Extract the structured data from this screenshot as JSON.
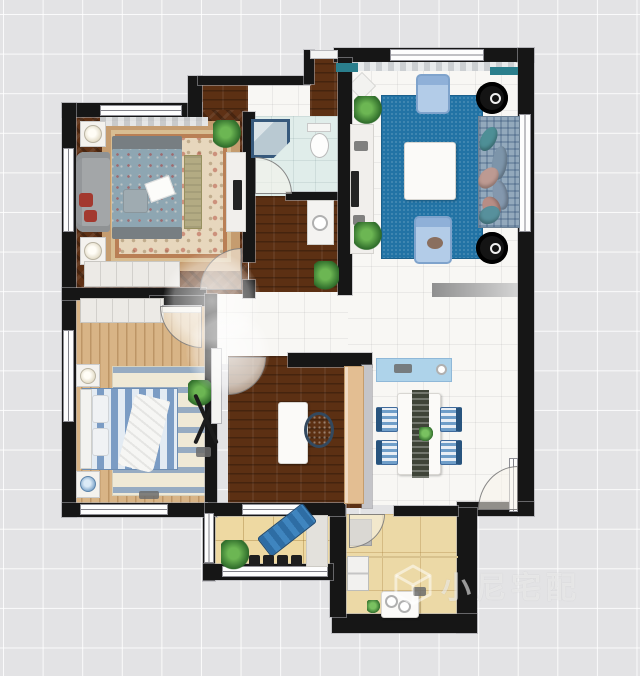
{
  "watermark": {
    "text": "小尼宅配"
  },
  "canvas": {
    "width": 640,
    "height": 676,
    "background": "#e3e3e5",
    "grid_line": "#ffffff"
  },
  "palette": {
    "wall": "#161616",
    "blue_carpet": "#2273a5",
    "dark_wood": "#5c3013",
    "light_wood": "#d8b486",
    "balcony_tile": "#eed9a2",
    "bath_floor": "#e0edea",
    "accent_teal": "#2a7e8c",
    "console_blue": "#aed3ea",
    "lounge_blue": "#2e6da4"
  },
  "elements": [
    {
      "n": "floor-living-dining",
      "k": "tile",
      "x": 345,
      "y": 58,
      "w": 175,
      "h": 447
    },
    {
      "n": "floor-center-hall",
      "k": "tile",
      "x": 200,
      "y": 286,
      "w": 148,
      "h": 78
    },
    {
      "n": "floor-entry",
      "k": "tile",
      "x": 246,
      "y": 78,
      "w": 68,
      "h": 42
    },
    {
      "n": "floor-entry-corridor",
      "k": "darkwood",
      "x": 310,
      "y": 54,
      "w": 30,
      "h": 66
    },
    {
      "n": "floor-entry-niche",
      "k": "darkwood",
      "x": 198,
      "y": 81,
      "w": 50,
      "h": 32
    },
    {
      "n": "floor-bedroom1",
      "k": "herringbone",
      "x": 70,
      "y": 110,
      "w": 178,
      "h": 184
    },
    {
      "n": "floor-bathroom",
      "k": "bath",
      "x": 249,
      "y": 116,
      "w": 92,
      "h": 82
    },
    {
      "n": "floor-hall-wood",
      "k": "darkwood",
      "x": 249,
      "y": 196,
      "w": 92,
      "h": 96
    },
    {
      "n": "floor-study",
      "k": "darkwood",
      "x": 228,
      "y": 356,
      "w": 142,
      "h": 152
    },
    {
      "n": "floor-bedroom2",
      "k": "lightwood",
      "x": 72,
      "y": 294,
      "w": 142,
      "h": 214
    },
    {
      "n": "floor-balcony",
      "k": "balconytile",
      "x": 213,
      "y": 510,
      "w": 120,
      "h": 62
    },
    {
      "n": "floor-kitchen",
      "k": "kitchentile",
      "x": 344,
      "y": 514,
      "w": 116,
      "h": 106
    },
    {
      "n": "rug-master",
      "k": "rugoriental",
      "x": 102,
      "y": 121,
      "w": 138,
      "h": 150
    },
    {
      "n": "carpet-living",
      "k": "bluecarpet",
      "x": 382,
      "y": 96,
      "w": 100,
      "h": 162
    },
    {
      "n": "rug-bedroom2",
      "k": "rugstripes",
      "x": 112,
      "y": 366,
      "w": 104,
      "h": 130
    },
    {
      "n": "mat-living-dining",
      "k": "graymat",
      "x": 432,
      "y": 283,
      "w": 88,
      "h": 14
    },
    {
      "n": "rug-diamond",
      "k": "diamond",
      "x": 352,
      "y": 76,
      "w": 20,
      "h": 20,
      "r": 45
    },
    {
      "n": "wall-top-bedroom",
      "k": "wall",
      "x": 62,
      "y": 103,
      "w": 140,
      "h": 14
    },
    {
      "n": "wall-step-left",
      "k": "wall",
      "x": 188,
      "y": 76,
      "w": 14,
      "h": 41
    },
    {
      "n": "wall-top-entry",
      "k": "wall",
      "x": 198,
      "y": 76,
      "w": 112,
      "h": 9
    },
    {
      "n": "wall-step-entry",
      "k": "wall",
      "x": 304,
      "y": 50,
      "w": 10,
      "h": 34
    },
    {
      "n": "wall-top-living",
      "k": "wall",
      "x": 334,
      "y": 48,
      "w": 200,
      "h": 14
    },
    {
      "n": "wall-right",
      "k": "wall",
      "x": 518,
      "y": 48,
      "w": 16,
      "h": 468
    },
    {
      "n": "wall-left",
      "k": "wall",
      "x": 62,
      "y": 103,
      "w": 14,
      "h": 414
    },
    {
      "n": "wall-bed1-bottom",
      "k": "wall",
      "x": 62,
      "y": 288,
      "w": 144,
      "h": 12
    },
    {
      "n": "wall-bed2-top-stub",
      "k": "wall",
      "x": 150,
      "y": 296,
      "w": 60,
      "h": 10
    },
    {
      "n": "wall-bed1-right",
      "k": "wall",
      "x": 243,
      "y": 112,
      "w": 12,
      "h": 150
    },
    {
      "n": "wall-bed1-right-stub",
      "k": "wall",
      "x": 243,
      "y": 280,
      "w": 12,
      "h": 18
    },
    {
      "n": "wall-bath-bottom",
      "k": "wall",
      "x": 286,
      "y": 192,
      "w": 55,
      "h": 8
    },
    {
      "n": "wall-living-left",
      "k": "wall",
      "x": 338,
      "y": 58,
      "w": 14,
      "h": 237
    },
    {
      "n": "wall-study-top",
      "k": "wall",
      "x": 288,
      "y": 353,
      "w": 84,
      "h": 14
    },
    {
      "n": "wall-study-right",
      "k": "graywall",
      "x": 362,
      "y": 365,
      "w": 10,
      "h": 143
    },
    {
      "n": "wall-bed2-right",
      "k": "wall",
      "x": 205,
      "y": 294,
      "w": 12,
      "h": 223
    },
    {
      "n": "wall-dining-bottom",
      "k": "wall",
      "x": 457,
      "y": 502,
      "w": 77,
      "h": 14
    },
    {
      "n": "wall-kitchen-right",
      "k": "wall",
      "x": 457,
      "y": 508,
      "w": 20,
      "h": 125
    },
    {
      "n": "wall-kitchen-bottom",
      "k": "wall",
      "x": 332,
      "y": 614,
      "w": 145,
      "h": 19
    },
    {
      "n": "wall-kitchen-left",
      "k": "wall",
      "x": 330,
      "y": 505,
      "w": 16,
      "h": 112
    },
    {
      "n": "wall-kitchen-top",
      "k": "wall",
      "x": 394,
      "y": 506,
      "w": 64,
      "h": 10
    },
    {
      "n": "wall-balcony-left",
      "k": "wall",
      "x": 203,
      "y": 505,
      "w": 12,
      "h": 76
    },
    {
      "n": "wall-balcony-bottom",
      "k": "wall",
      "x": 203,
      "y": 564,
      "w": 130,
      "h": 16
    },
    {
      "n": "wall-bed2-bottom",
      "k": "wall",
      "x": 62,
      "y": 503,
      "w": 145,
      "h": 14
    },
    {
      "n": "wall-study-bottom",
      "k": "wall",
      "x": 205,
      "y": 503,
      "w": 140,
      "h": 13
    },
    {
      "n": "window-bed1-top",
      "k": "windowh",
      "x": 100,
      "y": 105,
      "w": 82,
      "h": 11
    },
    {
      "n": "window-bed1-left",
      "k": "windowv",
      "x": 63,
      "y": 148,
      "w": 11,
      "h": 84
    },
    {
      "n": "window-bed2-left",
      "k": "windowv",
      "x": 63,
      "y": 330,
      "w": 11,
      "h": 92
    },
    {
      "n": "window-living-top",
      "k": "windowh",
      "x": 390,
      "y": 49,
      "w": 94,
      "h": 12
    },
    {
      "n": "window-living-right",
      "k": "windowv",
      "x": 519,
      "y": 114,
      "w": 12,
      "h": 118
    },
    {
      "n": "window-bed2-bottom",
      "k": "windowh",
      "x": 80,
      "y": 504,
      "w": 88,
      "h": 11
    },
    {
      "n": "window-study-bottom",
      "k": "windowh",
      "x": 242,
      "y": 504,
      "w": 60,
      "h": 11
    },
    {
      "n": "window-balcony-bottom",
      "k": "windowh",
      "x": 222,
      "y": 566,
      "w": 106,
      "h": 11
    },
    {
      "n": "window-balcony-left",
      "k": "windowv",
      "x": 204,
      "y": 513,
      "w": 10,
      "h": 50
    },
    {
      "n": "threshold-entry",
      "k": "thresh",
      "x": 310,
      "y": 50,
      "w": 28,
      "h": 9
    },
    {
      "n": "doorframe-dining-right",
      "k": "windowv",
      "x": 509,
      "y": 458,
      "w": 9,
      "h": 54
    },
    {
      "n": "curtain-living",
      "k": "curtain",
      "x": 352,
      "y": 62,
      "w": 164,
      "h": 9
    },
    {
      "n": "curtain-bed1",
      "k": "curtain",
      "x": 100,
      "y": 117,
      "w": 108,
      "h": 9
    },
    {
      "n": "entry-door-leaf",
      "k": "tealbar",
      "x": 336,
      "y": 63,
      "w": 22,
      "h": 9
    },
    {
      "n": "ac-unit-right",
      "k": "tealbar",
      "x": 490,
      "y": 67,
      "w": 28,
      "h": 8
    },
    {
      "n": "bed1-headboard",
      "k": "headboard",
      "x": 112,
      "y": 136,
      "w": 70,
      "h": 15
    },
    {
      "n": "bed1",
      "k": "bedmaster",
      "x": 112,
      "y": 149,
      "w": 70,
      "h": 80
    },
    {
      "n": "bed1-footboard",
      "k": "headboard",
      "x": 112,
      "y": 227,
      "w": 70,
      "h": 12
    },
    {
      "n": "bed1-pillow",
      "k": "pillowgray",
      "x": 123,
      "y": 189,
      "w": 25,
      "h": 24
    },
    {
      "n": "bed1-magazine",
      "k": "paper",
      "x": 147,
      "y": 179,
      "w": 26,
      "h": 20,
      "r": -20
    },
    {
      "n": "bench-bed1",
      "k": "bench",
      "x": 184,
      "y": 155,
      "w": 18,
      "h": 74
    },
    {
      "n": "sofa-bed1",
      "k": "graysofa",
      "x": 76,
      "y": 152,
      "w": 34,
      "h": 80
    },
    {
      "n": "sofa-cushion-red1",
      "k": "redpillow",
      "x": 79,
      "y": 193,
      "w": 14,
      "h": 14
    },
    {
      "n": "sofa-cushion-red2",
      "k": "redpillow",
      "x": 84,
      "y": 210,
      "w": 13,
      "h": 12
    },
    {
      "n": "nightstand-bed1-top",
      "k": "nightstand",
      "x": 80,
      "y": 121,
      "w": 26,
      "h": 26
    },
    {
      "n": "lamp-bed1-top",
      "k": "lamp",
      "x": 84,
      "y": 125,
      "w": 18,
      "h": 18
    },
    {
      "n": "nightstand-bed1-bottom",
      "k": "nightstand",
      "x": 80,
      "y": 237,
      "w": 26,
      "h": 28
    },
    {
      "n": "lamp-bed1-bottom",
      "k": "lamp",
      "x": 84,
      "y": 242,
      "w": 18,
      "h": 18
    },
    {
      "n": "wardrobe-bed1",
      "k": "wardrobe",
      "x": 84,
      "y": 261,
      "w": 96,
      "h": 26
    },
    {
      "n": "dresser-bed1",
      "k": "dresser",
      "x": 226,
      "y": 152,
      "w": 20,
      "h": 80
    },
    {
      "n": "tv-bed1",
      "k": "tv",
      "x": 233,
      "y": 180,
      "w": 9,
      "h": 30
    },
    {
      "n": "plant-bed1",
      "k": "plant",
      "x": 213,
      "y": 120,
      "w": 28,
      "h": 28
    },
    {
      "n": "door-bed1",
      "k": "arc-tl",
      "x": 200,
      "y": 248,
      "w": 42,
      "h": 42
    },
    {
      "n": "shower",
      "k": "shower",
      "x": 251,
      "y": 119,
      "w": 39,
      "h": 39
    },
    {
      "n": "toilet-tank",
      "k": "toilettank",
      "x": 307,
      "y": 123,
      "w": 24,
      "h": 9
    },
    {
      "n": "toilet-bowl",
      "k": "toiletbowl",
      "x": 310,
      "y": 133,
      "w": 19,
      "h": 25
    },
    {
      "n": "door-bathroom",
      "k": "arc-tr",
      "x": 255,
      "y": 157,
      "w": 37,
      "h": 37
    },
    {
      "n": "vanity-hall",
      "k": "vanity",
      "x": 307,
      "y": 200,
      "w": 27,
      "h": 45
    },
    {
      "n": "sink-vanity",
      "k": "burner",
      "x": 312,
      "y": 215,
      "w": 16,
      "h": 16
    },
    {
      "n": "plant-hall",
      "k": "plant",
      "x": 314,
      "y": 261,
      "w": 25,
      "h": 30
    },
    {
      "n": "tv-console-living",
      "k": "dresser",
      "x": 350,
      "y": 124,
      "w": 24,
      "h": 130
    },
    {
      "n": "tv-living",
      "k": "tv",
      "x": 351,
      "y": 171,
      "w": 8,
      "h": 36
    },
    {
      "n": "decor-glasses",
      "k": "smallitem",
      "x": 354,
      "y": 141,
      "w": 14,
      "h": 10
    },
    {
      "n": "decor-remotes",
      "k": "smallitem",
      "x": 353,
      "y": 215,
      "w": 12,
      "h": 10
    },
    {
      "n": "plant-living-top",
      "k": "plant",
      "x": 354,
      "y": 96,
      "w": 28,
      "h": 28
    },
    {
      "n": "plant-living-bottom",
      "k": "plant",
      "x": 354,
      "y": 222,
      "w": 28,
      "h": 28
    },
    {
      "n": "armchair-top",
      "k": "armchair",
      "x": 416,
      "y": 74,
      "w": 34,
      "h": 40
    },
    {
      "n": "armchair-bottom",
      "k": "armchair",
      "x": 414,
      "y": 216,
      "w": 38,
      "h": 48
    },
    {
      "n": "armchair-item",
      "k": "brownitem",
      "x": 427,
      "y": 237,
      "w": 16,
      "h": 12
    },
    {
      "n": "coffee-table",
      "k": "whitetable",
      "x": 404,
      "y": 142,
      "w": 52,
      "h": 58
    },
    {
      "n": "round-chair-top",
      "k": "roundchair",
      "x": 476,
      "y": 82,
      "w": 32,
      "h": 32
    },
    {
      "n": "round-chair-top-ring",
      "k": "ring",
      "x": 490,
      "y": 93,
      "w": 11,
      "h": 11
    },
    {
      "n": "round-chair-bottom",
      "k": "roundchair",
      "x": 476,
      "y": 232,
      "w": 32,
      "h": 32
    },
    {
      "n": "round-chair-bottom-ring",
      "k": "ring",
      "x": 490,
      "y": 243,
      "w": 11,
      "h": 11
    },
    {
      "n": "sofa-living",
      "k": "plaidsofa",
      "x": 478,
      "y": 116,
      "w": 42,
      "h": 112
    },
    {
      "n": "sofa-cushion-1",
      "k": "cushion",
      "f": "#4e8f96",
      "x": 481,
      "y": 126,
      "w": 15,
      "h": 26,
      "r": 28
    },
    {
      "n": "sofa-cushion-2",
      "k": "cushion",
      "f": "#7d95aa",
      "x": 492,
      "y": 146,
      "w": 15,
      "h": 34,
      "r": 8
    },
    {
      "n": "sofa-cushion-3",
      "k": "cushion",
      "f": "#8498ae",
      "x": 493,
      "y": 180,
      "w": 15,
      "h": 30,
      "r": -12
    },
    {
      "n": "sofa-cushion-4",
      "k": "cushion",
      "f": "#bd9a92",
      "x": 480,
      "y": 166,
      "w": 17,
      "h": 24,
      "r": 42
    },
    {
      "n": "sofa-cushion-5",
      "k": "cushion",
      "f": "#b78d85",
      "x": 483,
      "y": 196,
      "w": 17,
      "h": 22,
      "r": -30
    },
    {
      "n": "sofa-cushion-6",
      "k": "cushion",
      "f": "#57909c",
      "x": 481,
      "y": 204,
      "w": 17,
      "h": 22,
      "r": 62
    },
    {
      "n": "console-dining",
      "k": "consoleblue",
      "x": 376,
      "y": 358,
      "w": 76,
      "h": 24
    },
    {
      "n": "dish-console",
      "k": "smallitem",
      "x": 394,
      "y": 364,
      "w": 18,
      "h": 9
    },
    {
      "n": "knob-console",
      "k": "burner",
      "x": 436,
      "y": 364,
      "w": 11,
      "h": 11
    },
    {
      "n": "dining-table",
      "k": "whitetable",
      "x": 397,
      "y": 393,
      "w": 44,
      "h": 82
    },
    {
      "n": "table-runner",
      "k": "runner",
      "x": 412,
      "y": 390,
      "w": 17,
      "h": 88
    },
    {
      "n": "centerpiece",
      "k": "plantsmall",
      "x": 419,
      "y": 427,
      "w": 14,
      "h": 14
    },
    {
      "n": "dining-chair-1",
      "k": "chairleft",
      "x": 376,
      "y": 407,
      "w": 22,
      "h": 25
    },
    {
      "n": "dining-chair-2",
      "k": "chairleft",
      "x": 376,
      "y": 440,
      "w": 22,
      "h": 25
    },
    {
      "n": "dining-chair-3",
      "k": "chairright",
      "x": 440,
      "y": 407,
      "w": 22,
      "h": 25
    },
    {
      "n": "dining-chair-4",
      "k": "chairright",
      "x": 440,
      "y": 440,
      "w": 22,
      "h": 25
    },
    {
      "n": "door-main",
      "k": "arc-tl",
      "x": 478,
      "y": 466,
      "w": 40,
      "h": 44
    },
    {
      "n": "desk-study",
      "k": "whitetable",
      "x": 278,
      "y": 402,
      "w": 30,
      "h": 62
    },
    {
      "n": "office-chair",
      "k": "officechair",
      "x": 304,
      "y": 412,
      "w": 30,
      "h": 36
    },
    {
      "n": "cabinet-study",
      "k": "cabinettan",
      "x": 344,
      "y": 366,
      "w": 20,
      "h": 138
    },
    {
      "n": "door-study",
      "k": "arc-br",
      "x": 228,
      "y": 357,
      "w": 38,
      "h": 38
    },
    {
      "n": "wardrobe-bed2",
      "k": "wardrobe",
      "x": 80,
      "y": 298,
      "w": 84,
      "h": 25
    },
    {
      "n": "door-bed2-leaf",
      "k": "doorleaf",
      "x": 162,
      "y": 305,
      "w": 40,
      "h": 8
    },
    {
      "n": "door-bed2",
      "k": "arc-bl",
      "x": 160,
      "y": 306,
      "w": 42,
      "h": 42
    },
    {
      "n": "bed2",
      "k": "bedstripes",
      "x": 82,
      "y": 388,
      "w": 96,
      "h": 82
    },
    {
      "n": "bed2-headboard",
      "k": "headboard2",
      "x": 80,
      "y": 389,
      "w": 12,
      "h": 80
    },
    {
      "n": "pillow-bed2-1",
      "k": "pillow2",
      "x": 92,
      "y": 395,
      "w": 17,
      "h": 28
    },
    {
      "n": "pillow-bed2-2",
      "k": "pillow2",
      "x": 92,
      "y": 428,
      "w": 17,
      "h": 28
    },
    {
      "n": "blanket-bed2",
      "k": "blanket",
      "x": 126,
      "y": 396,
      "w": 36,
      "h": 74,
      "r": 14
    },
    {
      "n": "nightstand-bed2-top",
      "k": "nightstand",
      "x": 76,
      "y": 364,
      "w": 24,
      "h": 23
    },
    {
      "n": "lamp-bed2-top",
      "k": "lamp",
      "x": 80,
      "y": 368,
      "w": 16,
      "h": 16
    },
    {
      "n": "nightstand-bed2-bottom",
      "k": "nightstand",
      "x": 76,
      "y": 471,
      "w": 24,
      "h": 27
    },
    {
      "n": "lamp-bed2-bottom",
      "k": "lampblue",
      "x": 80,
      "y": 476,
      "w": 16,
      "h": 16
    },
    {
      "n": "plant-bed2",
      "k": "plant",
      "x": 188,
      "y": 380,
      "w": 26,
      "h": 26
    },
    {
      "n": "clothes-rack",
      "k": "rack",
      "x": 192,
      "y": 394,
      "w": 28,
      "h": 50
    },
    {
      "n": "rack-items",
      "k": "smallitem",
      "x": 196,
      "y": 447,
      "w": 15,
      "h": 10
    },
    {
      "n": "slippers",
      "k": "smallitem",
      "x": 139,
      "y": 491,
      "w": 20,
      "h": 8
    },
    {
      "n": "door-white-bed2",
      "k": "doorwhite",
      "x": 211,
      "y": 348,
      "w": 11,
      "h": 76
    },
    {
      "n": "mat-balcony",
      "k": "matlight",
      "x": 306,
      "y": 515,
      "w": 22,
      "h": 52
    },
    {
      "n": "lounge-chair",
      "k": "lounge",
      "x": 258,
      "y": 518,
      "w": 58,
      "h": 24,
      "r": -38
    },
    {
      "n": "stool-1",
      "k": "stool",
      "x": 249,
      "y": 555,
      "w": 11,
      "h": 11
    },
    {
      "n": "stool-2",
      "k": "stool",
      "x": 263,
      "y": 555,
      "w": 11,
      "h": 11
    },
    {
      "n": "stool-3",
      "k": "stool",
      "x": 277,
      "y": 555,
      "w": 11,
      "h": 11
    },
    {
      "n": "stool-4",
      "k": "stool",
      "x": 291,
      "y": 555,
      "w": 11,
      "h": 11
    },
    {
      "n": "plant-balcony",
      "k": "plant",
      "x": 221,
      "y": 540,
      "w": 28,
      "h": 30
    },
    {
      "n": "kitchen-divider-line",
      "k": "hairline",
      "x": 346,
      "y": 556,
      "w": 112,
      "h": 2
    },
    {
      "n": "counter-kitchen",
      "k": "graycounter",
      "x": 349,
      "y": 519,
      "w": 23,
      "h": 27
    },
    {
      "n": "fridge",
      "k": "fridge",
      "x": 347,
      "y": 556,
      "w": 22,
      "h": 35
    },
    {
      "n": "stove-kitchen",
      "k": "whitetable",
      "x": 381,
      "y": 591,
      "w": 38,
      "h": 27
    },
    {
      "n": "burner-1",
      "k": "burner",
      "x": 385,
      "y": 595,
      "w": 13,
      "h": 13
    },
    {
      "n": "burner-2",
      "k": "burner",
      "x": 398,
      "y": 600,
      "w": 13,
      "h": 13
    },
    {
      "n": "plant-kitchen",
      "k": "plantsmall",
      "x": 367,
      "y": 600,
      "w": 13,
      "h": 13
    },
    {
      "n": "item-kitchen",
      "k": "smallitem",
      "x": 413,
      "y": 587,
      "w": 13,
      "h": 9
    },
    {
      "n": "door-kitchen",
      "k": "arc-br",
      "x": 349,
      "y": 514,
      "w": 36,
      "h": 34
    },
    {
      "n": "light-glow-1",
      "k": "glow",
      "x": 163,
      "y": 252,
      "w": 98,
      "h": 98
    },
    {
      "n": "light-glow-2",
      "k": "glow",
      "x": 186,
      "y": 310,
      "w": 84,
      "h": 84
    }
  ]
}
